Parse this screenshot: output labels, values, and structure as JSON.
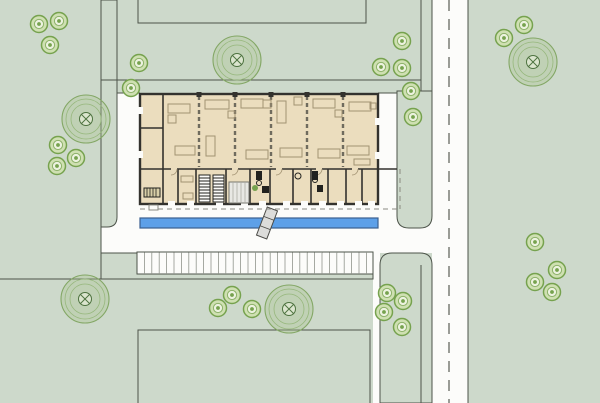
{
  "meta": {
    "type": "architectural-site-plan",
    "description": "Site plan with single-storey building, canal, parking strip, vertical road and planted blocks",
    "canvas_w": 600,
    "canvas_h": 403
  },
  "colors": {
    "bg_green": "#cdd9cb",
    "white": "#fcfcfa",
    "block_line": "#4d544a",
    "road_edge": "#5b5f57",
    "centerline": "#70746b",
    "building_fill": "#ebddbe",
    "wall": "#33322e",
    "partition": "#6f6b5e",
    "furniture": "#a29272",
    "fixture_dark": "#22221f",
    "canal_fill": "#5da0e8",
    "canal_stroke": "#3a5f8f",
    "bridge_fill": "#dcdcda",
    "bridge_stroke": "#4a4a46",
    "parking_hatch": "#90948c",
    "overhang": "#8a8a82",
    "tree_ring": "#83a765",
    "tree_ring_light": "#96b77c",
    "tree_center": "#4e7340",
    "tree_fill": "rgba(170,195,140,0.35)",
    "bush_fill": "#cfe0b2",
    "bush_ring": "#76a24e",
    "bush_inner": "#ecf2df",
    "bush_ring2": "#8cb168",
    "plant_green": "#76a24e",
    "counter_fill": "#e8e8e4",
    "counter_line": "#aaaaa4",
    "step_stroke": "#8a8a82"
  },
  "whites": [
    {
      "name": "road-vertical",
      "r": [
        432,
        0,
        36,
        403
      ]
    },
    {
      "name": "plaza-band",
      "r": [
        101,
        204,
        367,
        49
      ]
    },
    {
      "name": "walkway-west",
      "r": [
        117,
        93,
        23,
        112
      ]
    },
    {
      "name": "walkway-east",
      "r": [
        378,
        93,
        19,
        112
      ]
    },
    {
      "name": "footpath-south",
      "r": [
        373,
        253,
        7,
        150
      ]
    }
  ],
  "green_blocks": [
    {
      "name": "verge-strip-west",
      "d": "M101,0 L117,0 L117,217 Q117,227 107,227 L101,227 Z"
    },
    {
      "name": "corner-block-northeast",
      "d": "M397,91 L432,91 L432,216 Q432,228 420,228 L409,228 Q397,228 397,216 Z"
    },
    {
      "name": "corner-block-southeast",
      "d": "M380,265 Q380,253 392,253 L420,253 Q432,253 432,265 L432,403 L380,403 Z"
    },
    {
      "name": "block-south-strip",
      "r": [
        101,
        253,
        272,
        26
      ]
    }
  ],
  "lines": [
    {
      "name": "block-edge-west",
      "p": [
        101,
        0,
        101,
        279
      ]
    },
    {
      "name": "block-edge-south",
      "p": [
        0,
        279,
        373,
        279
      ]
    },
    {
      "name": "block-divider-north",
      "p": [
        101,
        80,
        421,
        80
      ]
    },
    {
      "name": "verge-line-north",
      "p": [
        421,
        0,
        421,
        91
      ]
    },
    {
      "name": "verge-line-south",
      "p": [
        421,
        265,
        421,
        403
      ]
    },
    {
      "name": "road-edge-left-top",
      "p": [
        432,
        0,
        432,
        91
      ]
    },
    {
      "name": "road-edge-right",
      "p": [
        468,
        0,
        468,
        403
      ]
    },
    {
      "name": "walkway-east-top-edge",
      "p": [
        378,
        93,
        397,
        93
      ]
    },
    {
      "name": "walkway-west-top-edge",
      "p": [
        117,
        93,
        140,
        93
      ]
    }
  ],
  "road_centerline": {
    "p": [
      449,
      0,
      449,
      403
    ],
    "dash": "11,8"
  },
  "plot_outlines": [
    {
      "name": "plot-outline-north",
      "points": "138,0 138,23 366,23 366,0"
    },
    {
      "name": "plot-outline-south",
      "points": "138,403 138,330 370,330 370,403"
    }
  ],
  "parking": {
    "r": [
      137,
      252,
      236,
      22
    ],
    "hatch_step": 7.4
  },
  "canal": {
    "r": [
      140,
      218,
      238,
      10
    ]
  },
  "bridge": {
    "cx": 267,
    "cy": 223,
    "w": 11,
    "h": 30,
    "angle": 21
  },
  "building": {
    "outer": [
      140,
      94,
      238,
      110
    ],
    "walls": [
      [
        163,
        94,
        163,
        169
      ],
      [
        140,
        128,
        163,
        128
      ],
      [
        140,
        169,
        378,
        169
      ],
      [
        163,
        169,
        163,
        204
      ],
      [
        178,
        169,
        178,
        204
      ],
      [
        196,
        169,
        196,
        204
      ],
      [
        226,
        169,
        226,
        204
      ],
      [
        250,
        169,
        250,
        204
      ],
      [
        270,
        169,
        270,
        204
      ],
      [
        293,
        169,
        293,
        204
      ],
      [
        311,
        169,
        311,
        204
      ],
      [
        328,
        169,
        328,
        204
      ],
      [
        346,
        169,
        346,
        204
      ],
      [
        362,
        169,
        362,
        204
      ],
      [
        378,
        169,
        397,
        169
      ]
    ],
    "partitions": [
      199,
      235,
      271,
      307,
      343
    ],
    "wall_gaps_south": [
      168,
      187,
      216,
      241,
      259,
      283,
      301,
      319,
      337,
      355,
      368
    ],
    "wall_gaps_corridor": [
      171,
      232,
      276,
      316,
      352
    ],
    "wall_gaps_west": [
      107,
      151
    ],
    "wall_gaps_east": [
      118,
      152
    ],
    "column_ticks": [
      199,
      235,
      271,
      307,
      343
    ],
    "furniture": [
      [
        168,
        104,
        22,
        9
      ],
      [
        168,
        115,
        8,
        8
      ],
      [
        175,
        146,
        20,
        9
      ],
      [
        205,
        100,
        24,
        9
      ],
      [
        228,
        111,
        7,
        7
      ],
      [
        206,
        136,
        9,
        20
      ],
      [
        241,
        99,
        22,
        9
      ],
      [
        263,
        100,
        8,
        8
      ],
      [
        246,
        150,
        22,
        9
      ],
      [
        277,
        101,
        9,
        22
      ],
      [
        294,
        97,
        8,
        8
      ],
      [
        280,
        148,
        22,
        9
      ],
      [
        313,
        99,
        22,
        9
      ],
      [
        335,
        110,
        7,
        7
      ],
      [
        318,
        149,
        22,
        9
      ],
      [
        349,
        102,
        22,
        9
      ],
      [
        370,
        103,
        6,
        6
      ],
      [
        347,
        146,
        22,
        9
      ],
      [
        354,
        159,
        16,
        6
      ],
      [
        181,
        176,
        12,
        6
      ],
      [
        183,
        193,
        10,
        6
      ]
    ],
    "stairs": [
      [
        199,
        175,
        11,
        27
      ],
      [
        213,
        175,
        11,
        27
      ]
    ],
    "desks_striped": [
      [
        144,
        188,
        16,
        9
      ]
    ],
    "counter": [
      229,
      182,
      20,
      21
    ],
    "dark_fixtures": [
      [
        256,
        171,
        6,
        9
      ],
      [
        262,
        186,
        7,
        7
      ],
      [
        312,
        171,
        6,
        9
      ],
      [
        317,
        185,
        6,
        7
      ]
    ],
    "fixture_circles": [
      [
        259,
        183,
        2.5
      ],
      [
        315,
        180,
        2.5
      ],
      [
        298,
        176,
        3
      ]
    ],
    "plant": [
      255,
      188,
      3
    ],
    "entry_step": [
      149,
      205,
      9,
      5
    ],
    "door_arcs": [
      171,
      232,
      276,
      316,
      352
    ],
    "overhang_dashed": [
      [
        140,
        209,
        397,
        209
      ],
      [
        400,
        169,
        400,
        209
      ]
    ]
  },
  "trees_large": [
    [
      86,
      119
    ],
    [
      237,
      60
    ],
    [
      533,
      62
    ],
    [
      85,
      299
    ],
    [
      289,
      309
    ]
  ],
  "trees_small": [
    [
      39,
      24
    ],
    [
      59,
      21
    ],
    [
      50,
      45
    ],
    [
      139,
      63
    ],
    [
      131,
      88
    ],
    [
      58,
      145
    ],
    [
      76,
      158
    ],
    [
      57,
      166
    ],
    [
      381,
      67
    ],
    [
      402,
      41
    ],
    [
      402,
      68
    ],
    [
      411,
      91
    ],
    [
      413,
      117
    ],
    [
      504,
      38
    ],
    [
      524,
      25
    ],
    [
      218,
      308
    ],
    [
      232,
      295
    ],
    [
      252,
      309
    ],
    [
      387,
      293
    ],
    [
      403,
      301
    ],
    [
      384,
      312
    ],
    [
      402,
      327
    ],
    [
      535,
      242
    ],
    [
      557,
      270
    ],
    [
      535,
      282
    ],
    [
      552,
      292
    ]
  ]
}
